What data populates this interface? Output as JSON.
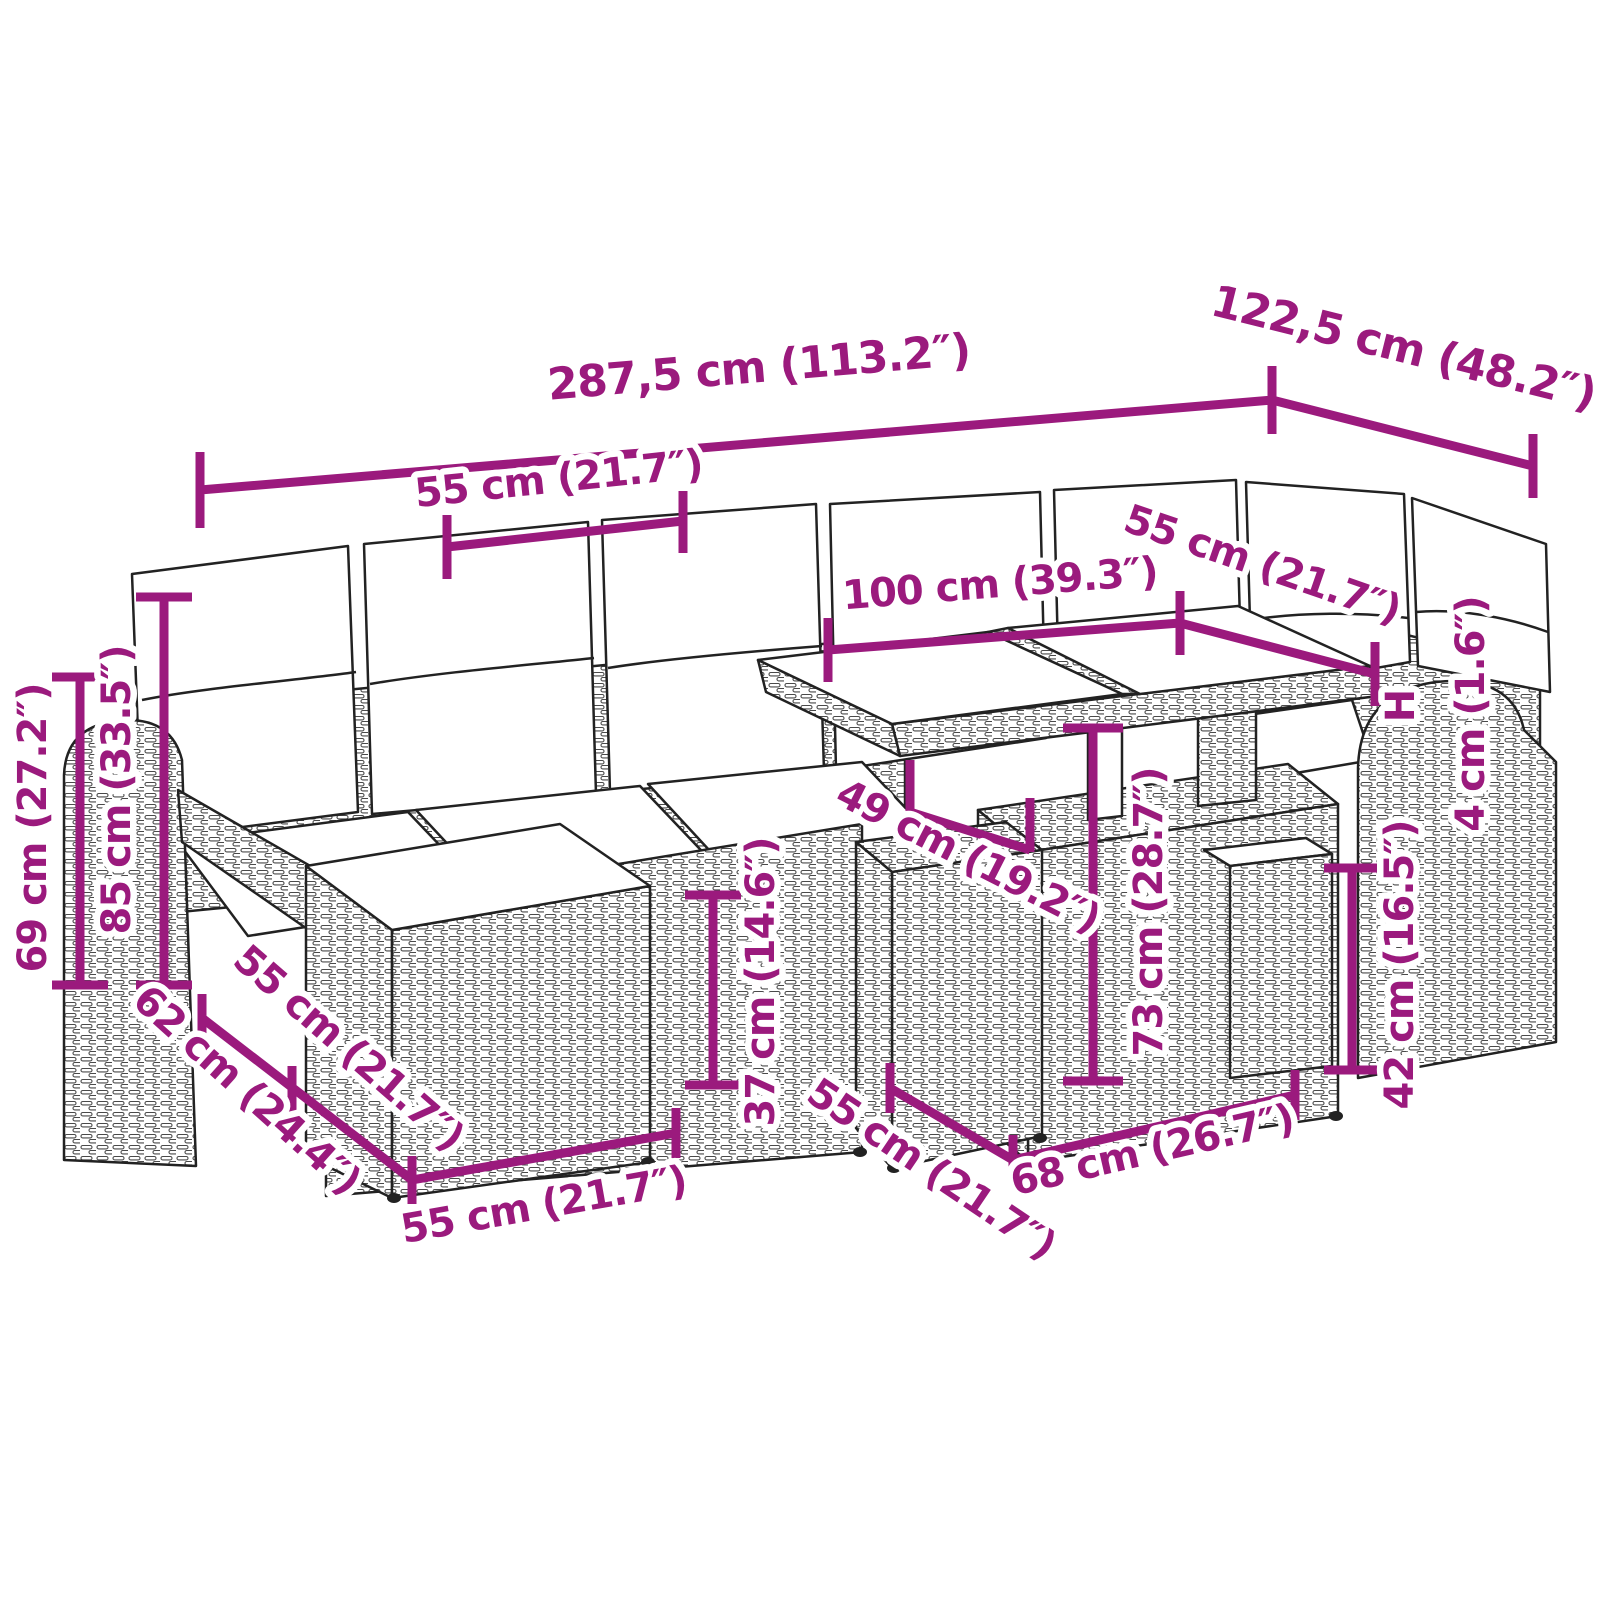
{
  "accent_color": "#9B1A7D",
  "outline_color": "#222222",
  "diagram": {
    "subject": "rattan-garden-lounge-set-with-cushions-and-glass-top-table",
    "dimensions": {
      "overall_width": "287,5 cm (113.2″)",
      "overall_depth": "122,5 cm (48.2″)",
      "seat_module_width_top": "55 cm (21.7″)",
      "table_length_top": "100 cm (39.3″)",
      "right_module_width": "55 cm (21.7″)",
      "cushion_height_symbol": "H",
      "cushion_thickness": "4 cm (1.6″)",
      "arm_height": "69 cm (27.2″)",
      "back_height": "85 cm (33.5″)",
      "seat_height": "37 cm (14.6″)",
      "table_base_depth": "49 cm (19.2″)",
      "table_height": "73 cm (28.7″)",
      "footstool_height": "42 cm (16.5″)",
      "sofa_depth": "62 cm (24.4″)",
      "seat_module_depth": "55 cm (21.7″)",
      "footstool_width_front": "55 cm (21.7″)",
      "table_base_front_depth": "55 cm (21.7″)",
      "table_base_width": "68 cm (26.7″)"
    }
  }
}
